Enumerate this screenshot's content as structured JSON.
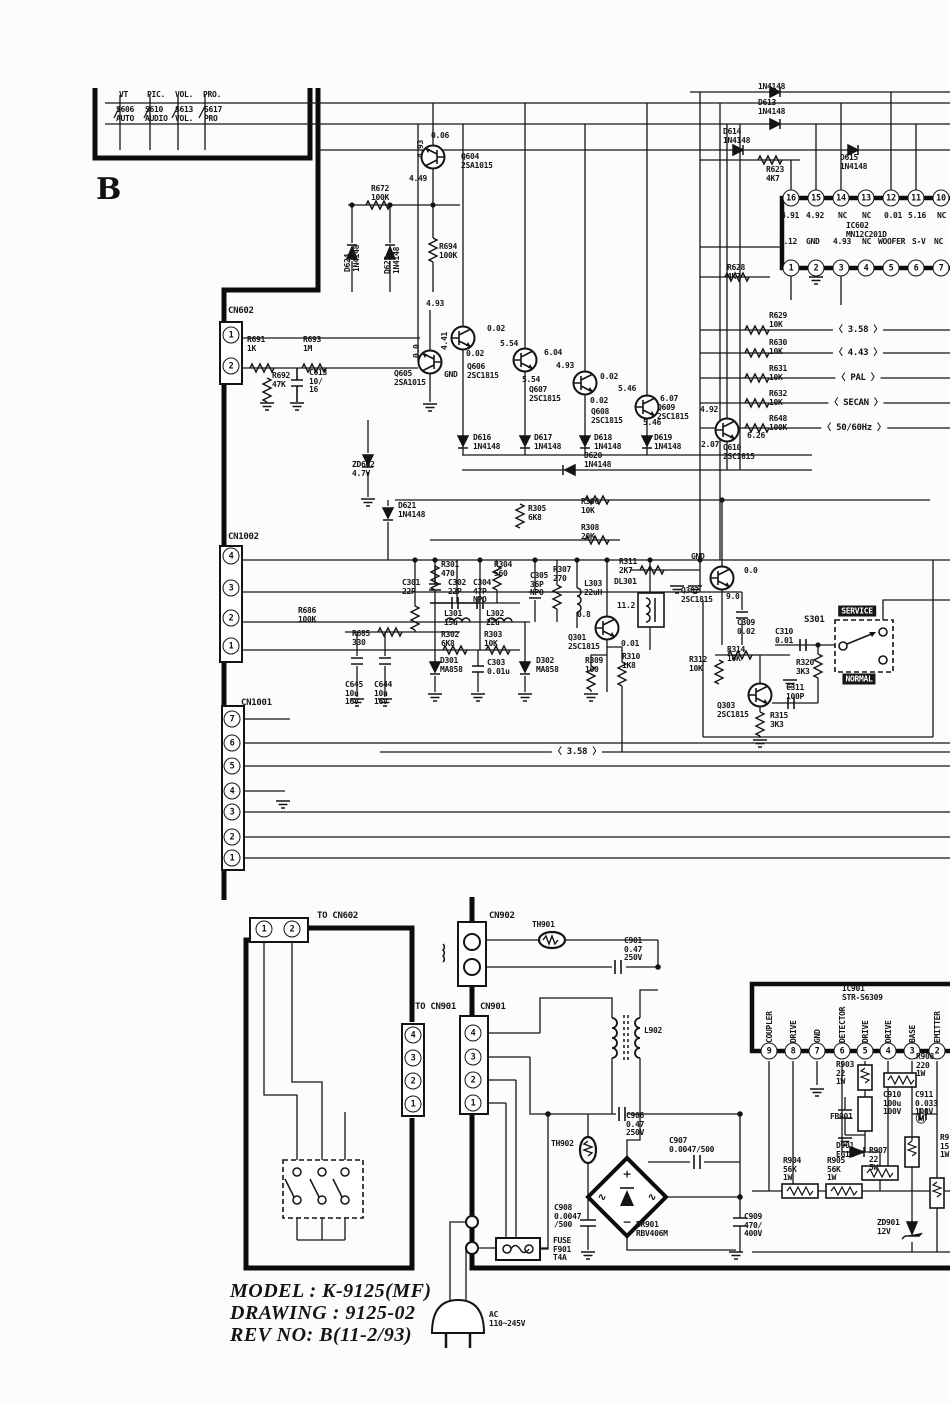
{
  "section_label": "B",
  "title_block": {
    "model": "MODEL : K-9125(MF)",
    "drawing": "DRAWING : 9125-02",
    "rev_no": "REV NO: B(11-2/93)"
  },
  "labels": [
    [
      "VT",
      119,
      91
    ],
    [
      "PIC.",
      147,
      91
    ],
    [
      "VOL.",
      175,
      91
    ],
    [
      "PRO.",
      203,
      91
    ],
    [
      "S606\nAUTO",
      116,
      106
    ],
    [
      "S610\nAUDIO",
      145,
      106
    ],
    [
      "S613\nVOL.",
      175,
      106
    ],
    [
      "S617\nPRO",
      204,
      106
    ],
    [
      "0.06",
      431,
      132
    ],
    [
      "4.93",
      417,
      158,
      "v"
    ],
    [
      "Q604\n2SA1015",
      461,
      153
    ],
    [
      "4.49",
      409,
      175
    ],
    [
      "R672\n100K",
      371,
      185
    ],
    [
      "D624\n1N4148",
      344,
      272,
      "v"
    ],
    [
      "D623\n1N4148",
      384,
      274,
      "v"
    ],
    [
      "R694\n100K",
      439,
      243
    ],
    [
      "1N4148",
      758,
      83
    ],
    [
      "D613\n1N4148",
      758,
      99
    ],
    [
      "D614\n1N4148",
      723,
      128
    ],
    [
      "D615\n1N4148",
      840,
      154
    ],
    [
      "R623\n4K7",
      766,
      166
    ],
    [
      "R628\n4K7",
      727,
      264
    ],
    [
      "IC602\nMN12C201D",
      846,
      222
    ],
    [
      "16",
      791,
      198,
      "pin"
    ],
    [
      "15",
      816,
      198,
      "pin"
    ],
    [
      "14",
      841,
      198,
      "pin"
    ],
    [
      "13",
      866,
      198,
      "pin"
    ],
    [
      "12",
      891,
      198,
      "pin"
    ],
    [
      "11",
      916,
      198,
      "pin"
    ],
    [
      "10",
      941,
      198,
      "pin"
    ],
    [
      "4.91",
      781,
      212
    ],
    [
      "4.92",
      806,
      212
    ],
    [
      "NC",
      838,
      212
    ],
    [
      "NC",
      862,
      212
    ],
    [
      "0.01",
      884,
      212
    ],
    [
      "5.16",
      908,
      212
    ],
    [
      "NC",
      937,
      212
    ],
    [
      "5.12",
      779,
      238
    ],
    [
      "GND",
      806,
      238
    ],
    [
      "4.93",
      833,
      238
    ],
    [
      "NC",
      862,
      238
    ],
    [
      "WOOFER",
      878,
      238
    ],
    [
      "S-V",
      912,
      238
    ],
    [
      "NC",
      934,
      238
    ],
    [
      "1",
      791,
      268,
      "pin"
    ],
    [
      "2",
      816,
      268,
      "pin"
    ],
    [
      "3",
      841,
      268,
      "pin"
    ],
    [
      "4",
      866,
      268,
      "pin"
    ],
    [
      "5",
      891,
      268,
      "pin"
    ],
    [
      "6",
      916,
      268,
      "pin"
    ],
    [
      "7",
      941,
      268,
      "pin"
    ],
    [
      "CN602",
      228,
      307,
      "hdr"
    ],
    [
      "1",
      231,
      335,
      "pin"
    ],
    [
      "2",
      231,
      366,
      "pin"
    ],
    [
      "R691\n1K",
      247,
      336
    ],
    [
      "R693\n1M",
      303,
      336
    ],
    [
      "R692\n47K",
      272,
      372
    ],
    [
      "C613\n10/\n16",
      309,
      369
    ],
    [
      "4.93",
      426,
      300
    ],
    [
      "0.0",
      413,
      358,
      "v"
    ],
    [
      "4.41",
      441,
      350,
      "v"
    ],
    [
      "GND",
      444,
      371
    ],
    [
      "Q605\n2SA1015",
      394,
      370
    ],
    [
      "0.02",
      487,
      325
    ],
    [
      "5.54",
      500,
      340
    ],
    [
      "0.02",
      466,
      350
    ],
    [
      "Q606\n2SC1815",
      467,
      363
    ],
    [
      "6.04",
      544,
      349
    ],
    [
      "5.54",
      522,
      376
    ],
    [
      "4.93",
      556,
      362
    ],
    [
      "Q607\n2SC1815",
      529,
      386
    ],
    [
      "0.02",
      600,
      373
    ],
    [
      "5.46",
      618,
      385
    ],
    [
      "0.02",
      590,
      397
    ],
    [
      "Q608\n2SC1815",
      591,
      408
    ],
    [
      "6.07",
      660,
      395
    ],
    [
      "5.46",
      643,
      419
    ],
    [
      "Q609\n2SC1815",
      657,
      404
    ],
    [
      "4.92",
      700,
      406
    ],
    [
      "2.07",
      701,
      441
    ],
    [
      "6.26",
      747,
      432
    ],
    [
      "Q610\n2SC1815",
      723,
      444
    ],
    [
      "D616\n1N4148",
      473,
      434
    ],
    [
      "D617\n1N4148",
      534,
      434
    ],
    [
      "D618\n1N4148",
      594,
      434
    ],
    [
      "D619\n1N4148",
      654,
      434
    ],
    [
      "D620\n1N4148",
      584,
      452
    ],
    [
      "ZD602\n4.7V",
      352,
      461
    ],
    [
      "D621\n1N4148",
      398,
      502
    ],
    [
      "R629\n10K",
      769,
      312
    ],
    [
      "3.58",
      858,
      330,
      "tag"
    ],
    [
      "R630\n10K",
      769,
      339
    ],
    [
      "4.43",
      858,
      353,
      "tag"
    ],
    [
      "R631\n10K",
      769,
      365
    ],
    [
      "PAL",
      858,
      378,
      "tag"
    ],
    [
      "R632\n10K",
      769,
      390
    ],
    [
      "SECAN",
      856,
      403,
      "tag"
    ],
    [
      "R648\n100K",
      769,
      415
    ],
    [
      "50/60Hz",
      854,
      428,
      "tag"
    ],
    [
      "R305\n6K8",
      528,
      505
    ],
    [
      "R306\n10K",
      581,
      498
    ],
    [
      "R308\n20K",
      581,
      524
    ],
    [
      "CN1002",
      228,
      533,
      "hdr"
    ],
    [
      "4",
      231,
      556,
      "pin"
    ],
    [
      "3",
      231,
      588,
      "pin"
    ],
    [
      "2",
      231,
      618,
      "pin"
    ],
    [
      "1",
      231,
      646,
      "pin"
    ],
    [
      "R686\n100K",
      298,
      607
    ],
    [
      "R685\n330",
      352,
      630
    ],
    [
      "C645\n10u\n16V",
      345,
      681
    ],
    [
      "C644\n10u\n16V",
      374,
      681
    ],
    [
      "C301\n22P",
      402,
      579
    ],
    [
      "R301\n470",
      441,
      561
    ],
    [
      "C302\n22P",
      448,
      579
    ],
    [
      "C304\n47P\nNPO",
      473,
      579
    ],
    [
      "R304\n560",
      494,
      561
    ],
    [
      "C305\n36P\nNPO",
      530,
      572
    ],
    [
      "R307\n270",
      553,
      566
    ],
    [
      "L303\n22uH",
      584,
      580
    ],
    [
      "L301\n15u",
      444,
      610
    ],
    [
      "L302\n22u",
      486,
      610
    ],
    [
      "R302\n6K8",
      441,
      631
    ],
    [
      "R303\n10K",
      484,
      631
    ],
    [
      "D301\nMA858",
      440,
      657
    ],
    [
      "C303\n0.01u",
      487,
      659
    ],
    [
      "D302\nMA858",
      536,
      657
    ],
    [
      "Q301\n2SC1815",
      568,
      634
    ],
    [
      "0.8",
      577,
      611
    ],
    [
      "11.2",
      617,
      602
    ],
    [
      "0.01",
      621,
      640
    ],
    [
      "R309\n100",
      585,
      657
    ],
    [
      "R310\n1K8",
      622,
      653
    ],
    [
      "R311\n2K7",
      619,
      558
    ],
    [
      "DL301",
      614,
      578
    ],
    [
      "GND",
      691,
      553
    ],
    [
      "Q302\n2SC1815",
      681,
      587
    ],
    [
      "0.0",
      744,
      567
    ],
    [
      "9.0",
      726,
      593
    ],
    [
      "C309\n0.02",
      737,
      619
    ],
    [
      "R314\n10K",
      727,
      646
    ],
    [
      "R312\n10K",
      689,
      656
    ],
    [
      "C310\n0.01",
      775,
      628
    ],
    [
      "S301",
      804,
      616,
      "hdr"
    ],
    [
      "SERVICE",
      857,
      611,
      "inv"
    ],
    [
      "NORMAL",
      859,
      679,
      "inv"
    ],
    [
      "R320\n3K3",
      796,
      659
    ],
    [
      "C311\n100P",
      786,
      684
    ],
    [
      "Q303\n2SC1815",
      717,
      702
    ],
    [
      "R315\n3K3",
      770,
      712
    ],
    [
      "CN1001",
      241,
      699,
      "hdr"
    ],
    [
      "7",
      232,
      719,
      "pin"
    ],
    [
      "6",
      232,
      743,
      "pin"
    ],
    [
      "5",
      232,
      766,
      "pin"
    ],
    [
      "4",
      232,
      791,
      "pin"
    ],
    [
      "3",
      232,
      812,
      "pin"
    ],
    [
      "2",
      232,
      837,
      "pin"
    ],
    [
      "1",
      232,
      858,
      "pin"
    ],
    [
      "3.58",
      577,
      752,
      "tag"
    ],
    [
      "TO CN602",
      317,
      912,
      "hdr"
    ],
    [
      "1",
      264,
      929,
      "pin"
    ],
    [
      "2",
      292,
      929,
      "pin"
    ],
    [
      "TO CN901",
      415,
      1003,
      "hdr"
    ],
    [
      "4",
      413,
      1035,
      "pin"
    ],
    [
      "3",
      413,
      1058,
      "pin"
    ],
    [
      "2",
      413,
      1081,
      "pin"
    ],
    [
      "1",
      413,
      1104,
      "pin"
    ],
    [
      "CN902",
      489,
      912,
      "hdr"
    ],
    [
      "TH901",
      532,
      921
    ],
    [
      "C901\n0.47\n250V",
      624,
      937
    ],
    [
      "CN901",
      480,
      1003,
      "hdr"
    ],
    [
      "4",
      473,
      1033,
      "pin"
    ],
    [
      "3",
      473,
      1057,
      "pin"
    ],
    [
      "2",
      473,
      1080,
      "pin"
    ],
    [
      "1",
      473,
      1103,
      "pin"
    ],
    [
      "L902",
      644,
      1027
    ],
    [
      "C906\n0.47\n250V",
      626,
      1112
    ],
    [
      "TH902",
      551,
      1140
    ],
    [
      "C907\n0.0047/500",
      669,
      1137
    ],
    [
      "BR901\nRBV406M",
      636,
      1221
    ],
    [
      "C908\n0.0047\n/500",
      554,
      1204
    ],
    [
      "FUSE\nF901\nT4A",
      553,
      1237
    ],
    [
      "C909\n470/\n400V",
      744,
      1213
    ],
    [
      "+",
      627,
      1174,
      "sym"
    ],
    [
      "−",
      627,
      1222,
      "sym"
    ],
    [
      "∿",
      602,
      1197,
      "sym"
    ],
    [
      "∿",
      652,
      1197,
      "sym"
    ],
    [
      "AC\n110~245V",
      489,
      1311
    ],
    [
      "IC901\nSTR-S6309",
      842,
      985
    ],
    [
      "COUPLER",
      766,
      1043,
      "v"
    ],
    [
      "DRIVE",
      790,
      1043,
      "v"
    ],
    [
      "GND",
      814,
      1043,
      "v"
    ],
    [
      "DETECTOR",
      839,
      1043,
      "v"
    ],
    [
      "DRIVE",
      862,
      1043,
      "v"
    ],
    [
      "DRIVE",
      885,
      1043,
      "v"
    ],
    [
      "BASE",
      909,
      1043,
      "v"
    ],
    [
      "EMITTER",
      934,
      1043,
      "v"
    ],
    [
      "9",
      769,
      1051,
      "pin"
    ],
    [
      "8",
      793,
      1051,
      "pin"
    ],
    [
      "7",
      817,
      1051,
      "pin"
    ],
    [
      "6",
      842,
      1051,
      "pin"
    ],
    [
      "5",
      865,
      1051,
      "pin"
    ],
    [
      "4",
      888,
      1051,
      "pin"
    ],
    [
      "3",
      912,
      1051,
      "pin"
    ],
    [
      "2",
      937,
      1051,
      "pin"
    ],
    [
      "R903\n22\n1W",
      836,
      1061
    ],
    [
      "R908\n220\n1W",
      916,
      1053
    ],
    [
      "C910\n100u\n100V",
      883,
      1091
    ],
    [
      "C911\n0.033\n100V",
      915,
      1091
    ],
    [
      "Ⓜ",
      921,
      1118,
      "sym"
    ],
    [
      "FB901",
      830,
      1113
    ],
    [
      "D901\nEG1Z",
      836,
      1142
    ],
    [
      "R907\n22\n5W",
      869,
      1147
    ],
    [
      "R904\n56K\n1W",
      783,
      1157
    ],
    [
      "R905\n56K\n1W",
      827,
      1157
    ],
    [
      "ZD901\n12V",
      877,
      1219
    ],
    [
      "R9\n15\n1W",
      940,
      1134
    ]
  ]
}
